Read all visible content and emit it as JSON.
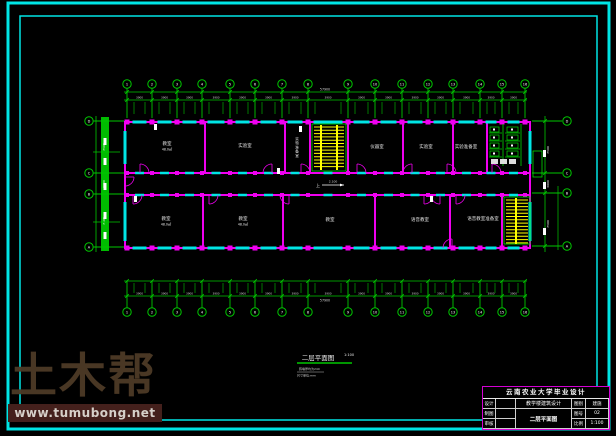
{
  "colors": {
    "border": "#00e5e5",
    "wall": "#f000f0",
    "window": "#00e5e5",
    "dim": "#00c800",
    "stair": "#ffff00",
    "fixture": "#00dd00",
    "text": "#e8e8e8",
    "dimtext": "#d8d8d8"
  },
  "axes": {
    "top": [
      "1",
      "2",
      "3",
      "4",
      "5",
      "6",
      "7",
      "8",
      "9",
      "10",
      "11",
      "12",
      "13",
      "14",
      "15",
      "16"
    ],
    "left": [
      "D",
      "C",
      "B",
      "A"
    ],
    "right": [
      "D",
      "C",
      "B",
      "A"
    ]
  },
  "dims": {
    "bay": "3900",
    "overall_top": "57900",
    "overall_bottom": "57900",
    "left": [
      "7500",
      "3000",
      "7500"
    ],
    "right": [
      "7500",
      "3000",
      "7500"
    ]
  },
  "rooms": {
    "top": [
      {
        "label": "教室",
        "area": "48.0㎡"
      },
      {
        "label": "实验室"
      },
      {
        "label": "实验准备室"
      },
      {
        "label": "仪器室"
      },
      {
        "label": "实验室"
      },
      {
        "label": "实验准备室"
      }
    ],
    "bottom": [
      {
        "label": "教室",
        "area": "48.0㎡"
      },
      {
        "label": "教室",
        "area": "48.0㎡"
      },
      {
        "label": "教室"
      },
      {
        "label": "语音教室"
      },
      {
        "label": "语音教室准备室"
      }
    ]
  },
  "annotations": {
    "stair_up": "上",
    "level": "2.100"
  },
  "caption": {
    "title": "二层平面图",
    "scale": "1:100",
    "note1": "砖墙厚均为240",
    "note2": "尺寸单位:mm"
  },
  "watermark": {
    "logo": "土木帮",
    "url": "www.tumubong.net"
  },
  "titleblock": {
    "title": "云南农业大学毕业设计",
    "r1c1": "设计",
    "r1c2": "",
    "r1c3": "教学楼建筑设计",
    "r1c4": "图别",
    "r1c5": "建施",
    "r2c1": "制图",
    "r2c2": "",
    "r2c3": "二层平面图",
    "r2c4": "图号",
    "r2c5": "02",
    "r3c1": "审核",
    "r3c2": "",
    "r3c4": "比例",
    "r3c5": "1:100"
  }
}
